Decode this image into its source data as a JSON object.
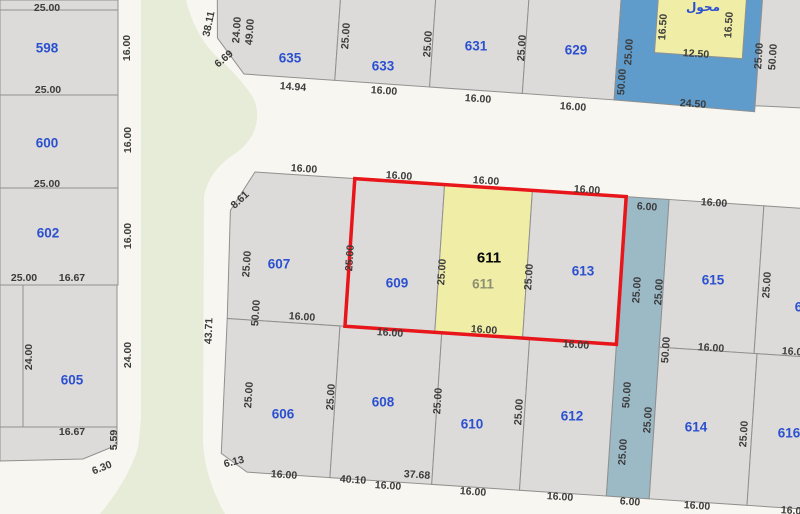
{
  "map": {
    "type": "cadastral-parcel-map",
    "highlighted_parcel": "611",
    "colors": {
      "road": "#f7f6f0",
      "road_median": "#e7ecd8",
      "parcel_fill": "#dcdbd9",
      "parcel_border": "#8f908f",
      "utility_parcel_blue": "#5f9bcb",
      "access_strip_blue": "#9cb9c6",
      "selected_parcel_yellow": "#efeda6",
      "selection_outline_red": "#e8151a",
      "parcel_number_blue": "#2b50d0",
      "dimension_text": "#3b3b3b",
      "muted_number": "#8d9070"
    },
    "parcels_visible": [
      "598",
      "600",
      "602",
      "605",
      "606",
      "607",
      "608",
      "609",
      "610",
      "611",
      "612",
      "613",
      "614",
      "615",
      "616",
      "617",
      "629",
      "631",
      "633",
      "635"
    ],
    "labels": [
      {
        "text": "25.00",
        "x": 47,
        "y": 8,
        "rot": 0,
        "kind": "dim"
      },
      {
        "text": "598",
        "x": 47,
        "y": 48,
        "rot": 0,
        "kind": "parcel"
      },
      {
        "text": "16.00",
        "x": 127,
        "y": 48,
        "rot": -90,
        "kind": "dim"
      },
      {
        "text": "25.00",
        "x": 48,
        "y": 90,
        "rot": 0,
        "kind": "dim"
      },
      {
        "text": "600",
        "x": 47,
        "y": 143,
        "rot": 0,
        "kind": "parcel"
      },
      {
        "text": "16.00",
        "x": 128,
        "y": 140,
        "rot": -90,
        "kind": "dim"
      },
      {
        "text": "25.00",
        "x": 47,
        "y": 184,
        "rot": 0,
        "kind": "dim"
      },
      {
        "text": "602",
        "x": 48,
        "y": 233,
        "rot": 0,
        "kind": "parcel"
      },
      {
        "text": "16.00",
        "x": 128,
        "y": 236,
        "rot": -90,
        "kind": "dim"
      },
      {
        "text": "25.00",
        "x": 24,
        "y": 278,
        "rot": 0,
        "kind": "dim"
      },
      {
        "text": "16.67",
        "x": 72,
        "y": 278,
        "rot": 0,
        "kind": "dim"
      },
      {
        "text": "24.00",
        "x": 29,
        "y": 357,
        "rot": -90,
        "kind": "dim"
      },
      {
        "text": "24.00",
        "x": 128,
        "y": 355,
        "rot": -90,
        "kind": "dim"
      },
      {
        "text": "605",
        "x": 72,
        "y": 380,
        "rot": 0,
        "kind": "parcel"
      },
      {
        "text": "16.67",
        "x": 72,
        "y": 432,
        "rot": 0,
        "kind": "dim"
      },
      {
        "text": "5.59",
        "x": 114,
        "y": 440,
        "rot": -90,
        "kind": "dim"
      },
      {
        "text": "6.30",
        "x": 102,
        "y": 468,
        "rot": -22,
        "kind": "dim"
      },
      {
        "text": "38.11",
        "x": 209,
        "y": 24,
        "rot": -78,
        "kind": "dim"
      },
      {
        "text": "24.00",
        "x": 237,
        "y": 30,
        "rot": -86,
        "kind": "dim"
      },
      {
        "text": "49.00",
        "x": 250,
        "y": 32,
        "rot": -86,
        "kind": "dim"
      },
      {
        "text": "6.69",
        "x": 224,
        "y": 59,
        "rot": -40,
        "kind": "dim"
      },
      {
        "text": "635",
        "x": 290,
        "y": 58,
        "rot": 0,
        "kind": "parcel"
      },
      {
        "text": "14.94",
        "x": 293,
        "y": 87,
        "rot": 4,
        "kind": "dim"
      },
      {
        "text": "25.00",
        "x": 346,
        "y": 36,
        "rot": -86,
        "kind": "dim"
      },
      {
        "text": "633",
        "x": 383,
        "y": 66,
        "rot": 0,
        "kind": "parcel"
      },
      {
        "text": "16.00",
        "x": 384,
        "y": 91,
        "rot": 4,
        "kind": "dim"
      },
      {
        "text": "25.00",
        "x": 428,
        "y": 44,
        "rot": -86,
        "kind": "dim"
      },
      {
        "text": "631",
        "x": 476,
        "y": 46,
        "rot": 0,
        "kind": "parcel"
      },
      {
        "text": "16.00",
        "x": 478,
        "y": 99,
        "rot": 4,
        "kind": "dim"
      },
      {
        "text": "25.00",
        "x": 522,
        "y": 48,
        "rot": -86,
        "kind": "dim"
      },
      {
        "text": "629",
        "x": 576,
        "y": 50,
        "rot": 0,
        "kind": "parcel"
      },
      {
        "text": "16.00",
        "x": 573,
        "y": 107,
        "rot": 4,
        "kind": "dim"
      },
      {
        "text": "25.00",
        "x": 629,
        "y": 52,
        "rot": -86,
        "kind": "dim"
      },
      {
        "text": "50.00",
        "x": 622,
        "y": 82,
        "rot": -86,
        "kind": "dim"
      },
      {
        "text": "محول",
        "x": 703,
        "y": 7,
        "rot": 0,
        "kind": "ar"
      },
      {
        "text": "16.50",
        "x": 663,
        "y": 27,
        "rot": -86,
        "kind": "dim"
      },
      {
        "text": "16.50",
        "x": 729,
        "y": 25,
        "rot": -86,
        "kind": "dim"
      },
      {
        "text": "12.50",
        "x": 696,
        "y": 54,
        "rot": 4,
        "kind": "dim"
      },
      {
        "text": "24.50",
        "x": 693,
        "y": 104,
        "rot": 4,
        "kind": "dim"
      },
      {
        "text": "25.00",
        "x": 759,
        "y": 56,
        "rot": -86,
        "kind": "dim"
      },
      {
        "text": "50.00",
        "x": 773,
        "y": 57,
        "rot": -86,
        "kind": "dim"
      },
      {
        "text": "16.00",
        "x": 304,
        "y": 169,
        "rot": 4,
        "kind": "dim"
      },
      {
        "text": "8.61",
        "x": 240,
        "y": 200,
        "rot": -43,
        "kind": "dim"
      },
      {
        "text": "25.00",
        "x": 247,
        "y": 264,
        "rot": -86,
        "kind": "dim"
      },
      {
        "text": "607",
        "x": 279,
        "y": 264,
        "rot": 0,
        "kind": "parcel"
      },
      {
        "text": "50.00",
        "x": 256,
        "y": 313,
        "rot": -86,
        "kind": "dim"
      },
      {
        "text": "43.71",
        "x": 209,
        "y": 331,
        "rot": -88,
        "kind": "dim"
      },
      {
        "text": "16.00",
        "x": 302,
        "y": 317,
        "rot": 4,
        "kind": "dim"
      },
      {
        "text": "16.00",
        "x": 399,
        "y": 176,
        "rot": 4,
        "kind": "dim"
      },
      {
        "text": "25.00",
        "x": 350,
        "y": 258,
        "rot": -86,
        "kind": "dim"
      },
      {
        "text": "609",
        "x": 397,
        "y": 283,
        "rot": 0,
        "kind": "parcel"
      },
      {
        "text": "16.00",
        "x": 390,
        "y": 333,
        "rot": 4,
        "kind": "dim"
      },
      {
        "text": "16.00",
        "x": 486,
        "y": 181,
        "rot": 4,
        "kind": "dim"
      },
      {
        "text": "611",
        "x": 489,
        "y": 258,
        "rot": 0,
        "kind": "black"
      },
      {
        "text": "611",
        "x": 483,
        "y": 284,
        "rot": 0,
        "kind": "muted"
      },
      {
        "text": "25.00",
        "x": 442,
        "y": 272,
        "rot": -86,
        "kind": "dim"
      },
      {
        "text": "25.00",
        "x": 529,
        "y": 277,
        "rot": -86,
        "kind": "dim"
      },
      {
        "text": "16.00",
        "x": 484,
        "y": 330,
        "rot": 4,
        "kind": "dim"
      },
      {
        "text": "16.00",
        "x": 587,
        "y": 190,
        "rot": 4,
        "kind": "dim"
      },
      {
        "text": "613",
        "x": 583,
        "y": 271,
        "rot": 0,
        "kind": "parcel"
      },
      {
        "text": "16.00",
        "x": 576,
        "y": 345,
        "rot": 4,
        "kind": "dim"
      },
      {
        "text": "25.00",
        "x": 637,
        "y": 290,
        "rot": -86,
        "kind": "dim"
      },
      {
        "text": "25.00",
        "x": 659,
        "y": 292,
        "rot": -86,
        "kind": "dim"
      },
      {
        "text": "6.00",
        "x": 647,
        "y": 207,
        "rot": 4,
        "kind": "dim"
      },
      {
        "text": "16.00",
        "x": 714,
        "y": 203,
        "rot": 4,
        "kind": "dim"
      },
      {
        "text": "615",
        "x": 713,
        "y": 280,
        "rot": 0,
        "kind": "parcel"
      },
      {
        "text": "25.00",
        "x": 767,
        "y": 285,
        "rot": -86,
        "kind": "dim"
      },
      {
        "text": "617",
        "x": 806,
        "y": 307,
        "rot": 0,
        "kind": "parcel"
      },
      {
        "text": "25.00",
        "x": 249,
        "y": 395,
        "rot": -86,
        "kind": "dim"
      },
      {
        "text": "606",
        "x": 283,
        "y": 414,
        "rot": 0,
        "kind": "parcel"
      },
      {
        "text": "6.13",
        "x": 234,
        "y": 462,
        "rot": -14,
        "kind": "dim"
      },
      {
        "text": "16.00",
        "x": 284,
        "y": 475,
        "rot": 4,
        "kind": "dim"
      },
      {
        "text": "25.00",
        "x": 331,
        "y": 397,
        "rot": -86,
        "kind": "dim"
      },
      {
        "text": "608",
        "x": 383,
        "y": 402,
        "rot": 0,
        "kind": "parcel"
      },
      {
        "text": "40.10",
        "x": 353,
        "y": 480,
        "rot": 4,
        "kind": "dim"
      },
      {
        "text": "16.00",
        "x": 388,
        "y": 486,
        "rot": 4,
        "kind": "dim"
      },
      {
        "text": "37.68",
        "x": 417,
        "y": 475,
        "rot": 4,
        "kind": "dim"
      },
      {
        "text": "25.00",
        "x": 438,
        "y": 401,
        "rot": -86,
        "kind": "dim"
      },
      {
        "text": "610",
        "x": 472,
        "y": 424,
        "rot": 0,
        "kind": "parcel"
      },
      {
        "text": "16.00",
        "x": 473,
        "y": 492,
        "rot": 4,
        "kind": "dim"
      },
      {
        "text": "25.00",
        "x": 519,
        "y": 412,
        "rot": -86,
        "kind": "dim"
      },
      {
        "text": "612",
        "x": 572,
        "y": 416,
        "rot": 0,
        "kind": "parcel"
      },
      {
        "text": "16.00",
        "x": 560,
        "y": 497,
        "rot": 4,
        "kind": "dim"
      },
      {
        "text": "50.00",
        "x": 627,
        "y": 395,
        "rot": -86,
        "kind": "dim"
      },
      {
        "text": "25.00",
        "x": 623,
        "y": 452,
        "rot": -86,
        "kind": "dim"
      },
      {
        "text": "50.00",
        "x": 666,
        "y": 350,
        "rot": -86,
        "kind": "dim"
      },
      {
        "text": "25.00",
        "x": 648,
        "y": 420,
        "rot": -86,
        "kind": "dim"
      },
      {
        "text": "6.00",
        "x": 630,
        "y": 502,
        "rot": 4,
        "kind": "dim"
      },
      {
        "text": "16.00",
        "x": 711,
        "y": 348,
        "rot": 4,
        "kind": "dim"
      },
      {
        "text": "614",
        "x": 696,
        "y": 427,
        "rot": 0,
        "kind": "parcel"
      },
      {
        "text": "25.00",
        "x": 744,
        "y": 434,
        "rot": -86,
        "kind": "dim"
      },
      {
        "text": "616",
        "x": 789,
        "y": 433,
        "rot": 0,
        "kind": "parcel"
      },
      {
        "text": "16.00",
        "x": 795,
        "y": 352,
        "rot": 4,
        "kind": "dim"
      },
      {
        "text": "16.00",
        "x": 697,
        "y": 506,
        "rot": 4,
        "kind": "dim"
      },
      {
        "text": "16.00",
        "x": 794,
        "y": 511,
        "rot": 4,
        "kind": "dim"
      }
    ]
  }
}
